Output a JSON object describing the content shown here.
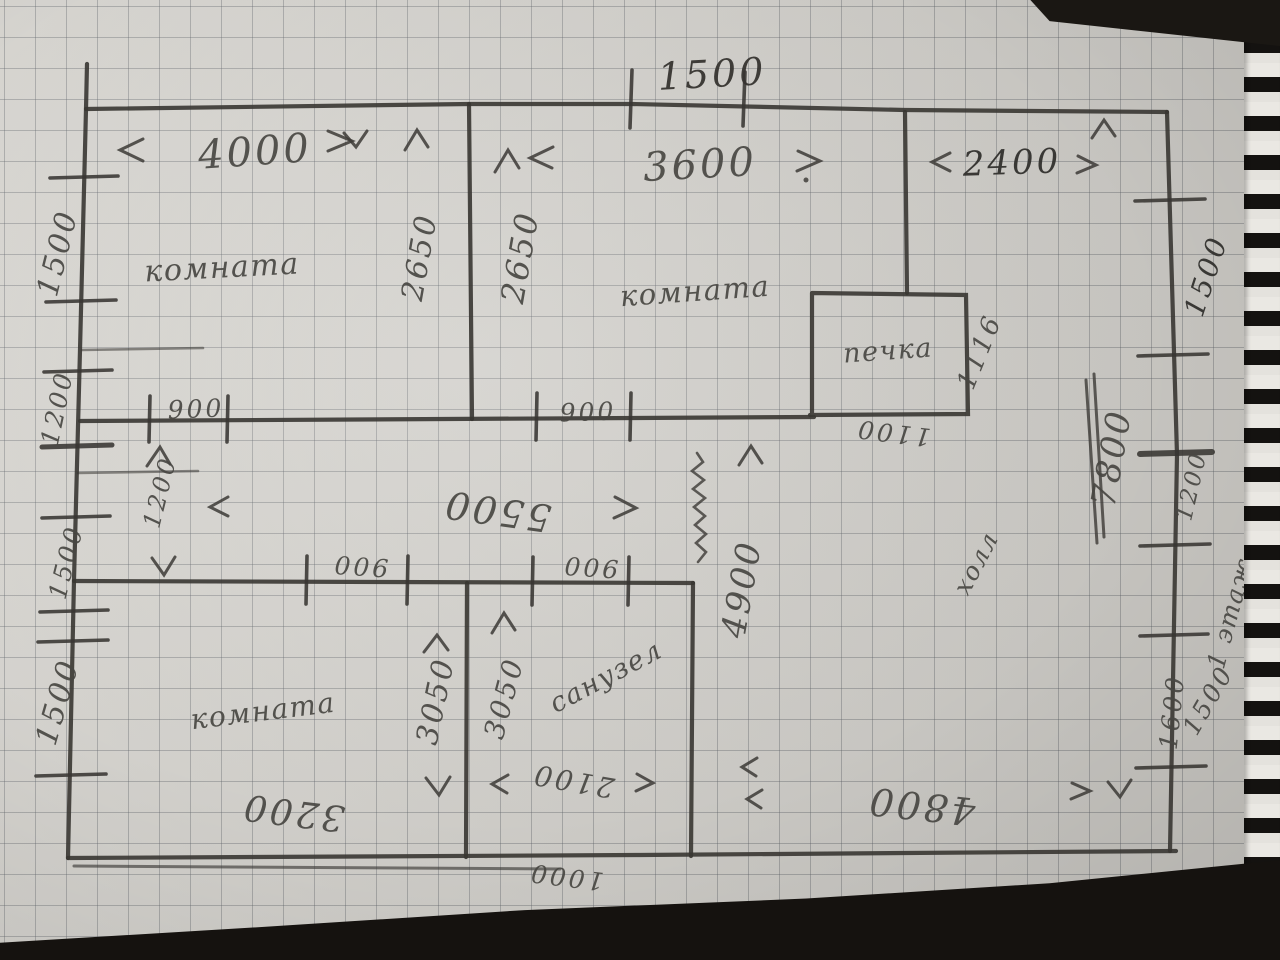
{
  "colors": {
    "paper": "#d8d6d1",
    "grid_line": "#60646c",
    "pencil": "#4a4845",
    "pen_dark": "#36342f",
    "table_background": "#15120f"
  },
  "plan": {
    "top": {
      "gap": "1500",
      "room1_width": "4000",
      "room2_width": "3600",
      "right_width": "2400"
    },
    "rooms": {
      "top_left": "комната",
      "top_middle": "комната",
      "bottom_left": "комната",
      "bathroom": "санузел",
      "hall": "холл",
      "stove": "печка"
    },
    "left_edge": {
      "s1500_top": "1500",
      "s1200": "1200",
      "s1500_mid": "1500",
      "s1500_bottom": "1500"
    },
    "right_edge": {
      "s1500_top": "1500",
      "total": "7800",
      "s1200": "1200",
      "floor": "1 этаж",
      "s1500_bottom": "1500",
      "s1600": "1600"
    },
    "interior": {
      "h2650_left": "2650",
      "h2650_right": "2650",
      "door_a": "900",
      "door_b": "900",
      "door_c": "900",
      "door_d": "900",
      "corridor_length": "5500",
      "corridor_width": "1200",
      "hall_depth": "4900",
      "hall_width": "4800",
      "room3_width": "3200",
      "room3_height": "3050",
      "bath_height": "3050",
      "bath_width": "2100",
      "bath_bottom": "1000",
      "stove_depth": "1116",
      "stove_width": "1100"
    }
  }
}
